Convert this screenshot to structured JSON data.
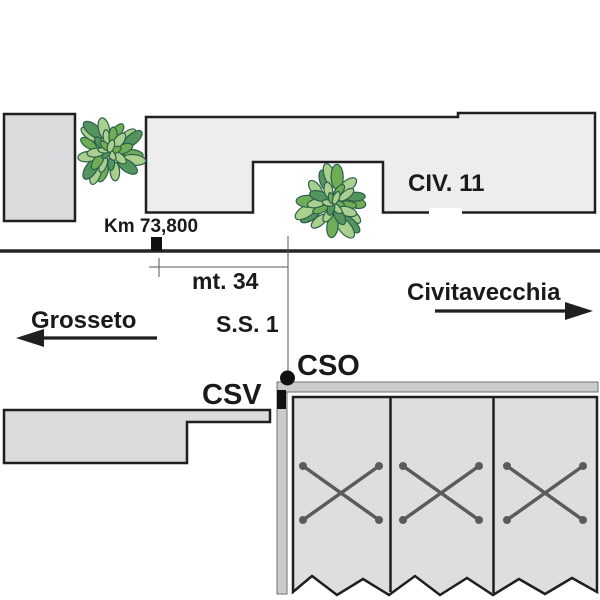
{
  "labels": {
    "km_marker": "Km 73,800",
    "distance": "mt. 34",
    "road_name": "S.S. 1",
    "direction_west": "Grosseto",
    "direction_east": "Civitavecchia",
    "building_civic": "CIV. 11",
    "point_cso": "CSO",
    "point_csv": "CSV"
  },
  "colors": {
    "outline": "#1f1f1f",
    "building_light": "#ededee",
    "building_mid": "#dadbdc",
    "panel_fill": "#dcdedf",
    "band_fill": "#c9cbcc",
    "marker_black": "#111111",
    "x_mark": "#595b5d",
    "leaf_light": "#a9d08e",
    "leaf_mid": "#6fae57",
    "leaf_dark": "#54945f",
    "leaf_outline": "#2d604a",
    "text": "#1a1a1a"
  }
}
